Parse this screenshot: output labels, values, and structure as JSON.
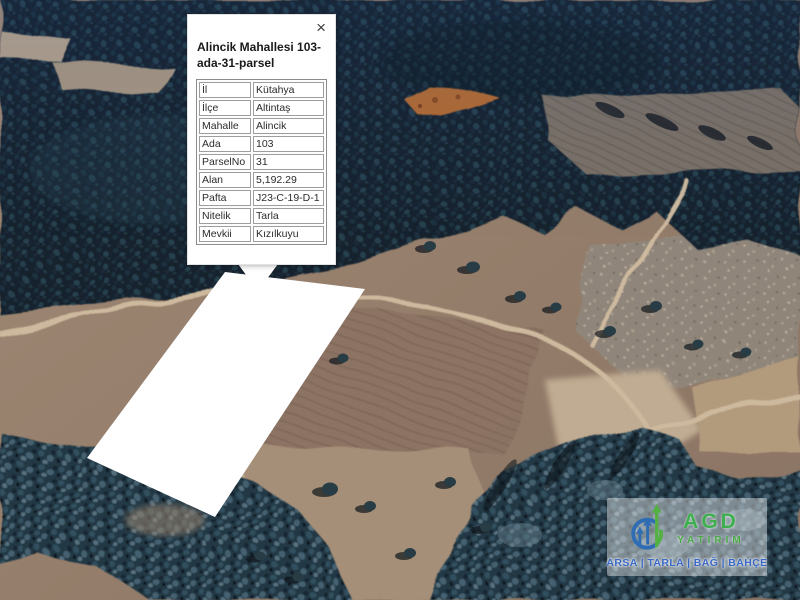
{
  "popup": {
    "close_label": "×",
    "title": "Alincik Mahallesi 103-ada-31-parsel",
    "table": {
      "rows": [
        {
          "label": "İl",
          "value": "Kütahya"
        },
        {
          "label": "İlçe",
          "value": "Altintaş"
        },
        {
          "label": "Mahalle",
          "value": "Alincik"
        },
        {
          "label": "Ada",
          "value": "103"
        },
        {
          "label": "ParselNo",
          "value": "31"
        },
        {
          "label": "Alan",
          "value": "5,192.29"
        },
        {
          "label": "Pafta",
          "value": "J23-C-19-D-1"
        },
        {
          "label": "Nitelik",
          "value": "Tarla"
        },
        {
          "label": "Mevkii",
          "value": "Kızılkuyu"
        }
      ]
    }
  },
  "watermark": {
    "brand": "AGD",
    "subtitle": "YATIRIM",
    "tagline": "ARSA | TARLA | BAĞ | BAHÇE",
    "colors": {
      "brand_green": "#3fae4e",
      "brand_blue": "#2e6db4",
      "tagline_blue": "#3968c5"
    }
  },
  "scene": {
    "colors": {
      "parcel_fill": "#ffffff",
      "forest_dark": "#16222d",
      "forest_blue": "#243845",
      "field_tan": "#9a8471",
      "road_light": "#cdb99e",
      "dirt_orange": "#b26a33"
    }
  }
}
